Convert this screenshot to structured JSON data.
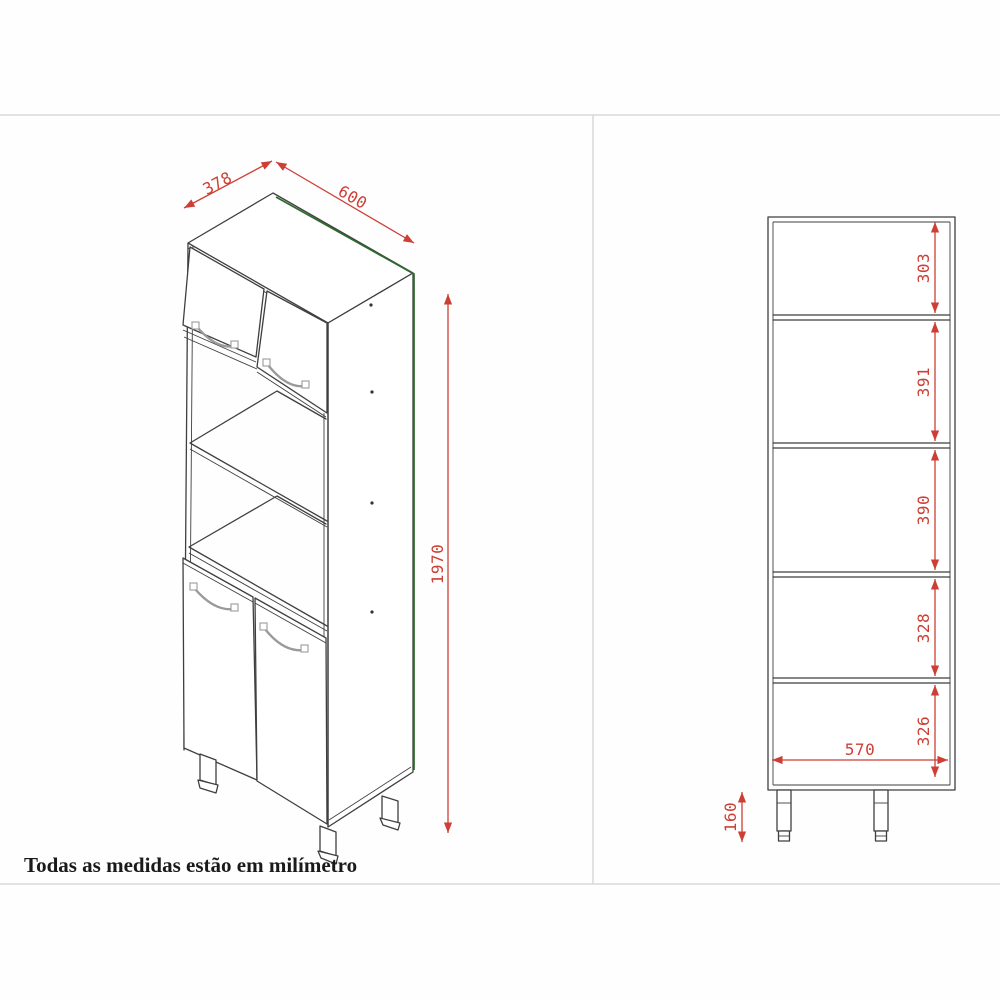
{
  "note": "Todas as medidas estão em milímetro",
  "colors": {
    "dimension": "#cd3f35",
    "highlight": "#2d6b2d",
    "line": "#3f3f3f",
    "divider": "#d8d8d8",
    "handle": "#9a9a9a"
  },
  "isometric_view": {
    "dimensions": {
      "depth": "378",
      "width": "600",
      "height": "1970"
    }
  },
  "front_elevation": {
    "section_heights": [
      "303",
      "391",
      "390",
      "328",
      "326"
    ],
    "inner_width": "570",
    "leg_height": "160"
  }
}
